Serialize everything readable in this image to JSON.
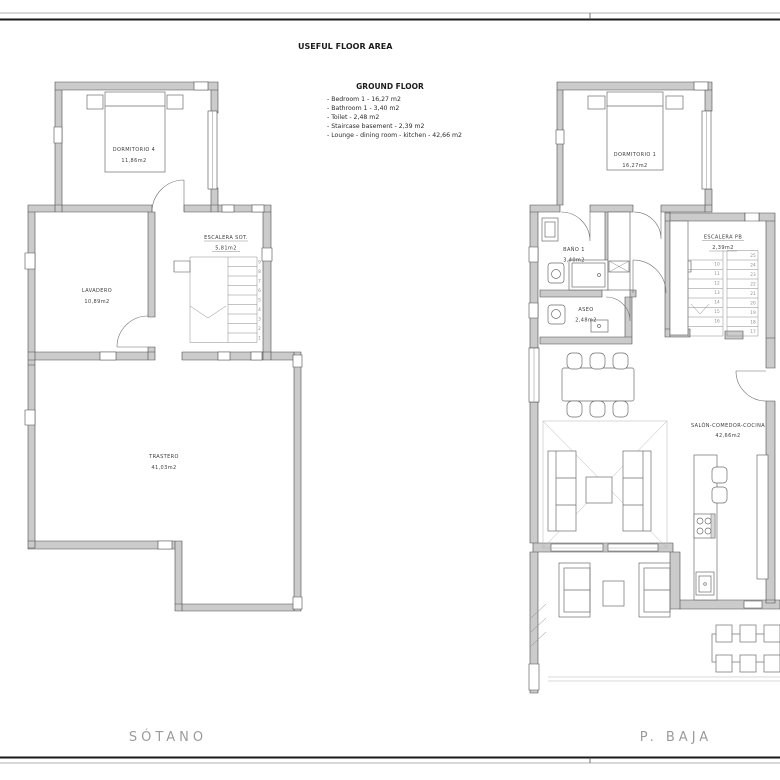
{
  "sheet": {
    "title": "USEFUL FLOOR AREA"
  },
  "legend": {
    "heading": "GROUND FLOOR",
    "items": [
      "- Bedroom 1 - 16,27 m2",
      "- Bathroom 1 - 3,40 m2",
      "- Toilet - 2,48 m2",
      "- Staircase basement - 2,39 m2",
      "- Lounge - dining room - kitchen - 42,66 m2"
    ]
  },
  "plans": {
    "sotano": {
      "floor_label": "SÓTANO",
      "rooms": {
        "dormitorio4": {
          "name": "DORMITORIO  4",
          "area": "11,86m2"
        },
        "lavadero": {
          "name": "LAVADERO",
          "area": "10,89m2"
        },
        "escalera": {
          "name": "ESCALERA  SOT.",
          "area": "5,81m2"
        },
        "trastero": {
          "name": "TRASTERO",
          "area": "41,03m2"
        }
      },
      "stairs": [
        "1",
        "2",
        "3",
        "4",
        "5",
        "6",
        "7",
        "8",
        "9"
      ]
    },
    "pbaja": {
      "floor_label": "P. BAJA",
      "rooms": {
        "dormitorio1": {
          "name": "DORMITORIO  1",
          "area": "16,27m2"
        },
        "bano": {
          "name": "BAÑO  1",
          "area": "3,40m2"
        },
        "aseo": {
          "name": "ASEO",
          "area": "2,48m2"
        },
        "escalera": {
          "name": "ESCALERA  PB",
          "area": "2,39m2"
        },
        "salon": {
          "name": "SALÓN-COMEDOR-COCINA",
          "area": "42,66m2"
        }
      },
      "stairs_up": [
        "10",
        "11",
        "12",
        "13",
        "14",
        "15",
        "16"
      ],
      "stairs_down": [
        "25",
        "24",
        "23",
        "22",
        "21",
        "20",
        "19",
        "18",
        "17"
      ]
    }
  },
  "colors": {
    "wall_fill": "#cbcbcb",
    "wall_line": "#4d4d4d",
    "furniture_line": "#6e6e6e",
    "floor_label": "#9b9b9b",
    "paper": "#ffffff"
  }
}
